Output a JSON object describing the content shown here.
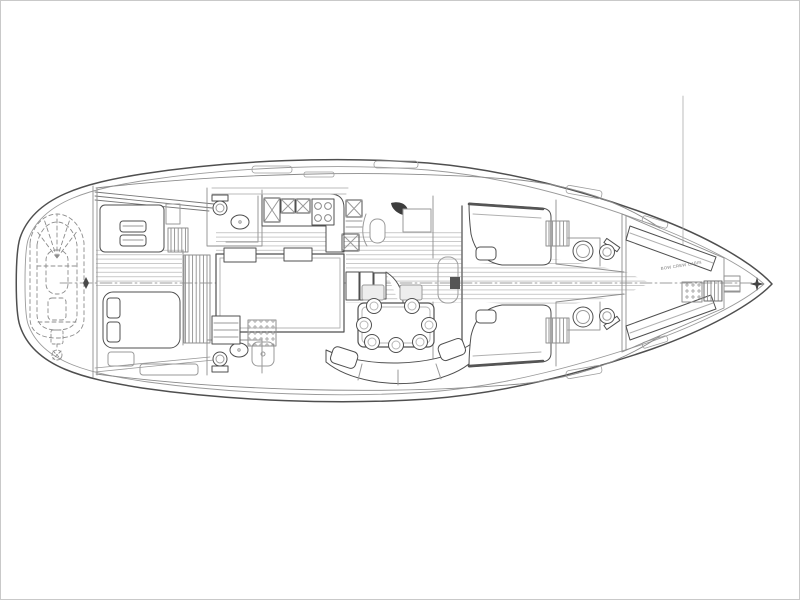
{
  "canvas": {
    "width": 800,
    "height": 600,
    "background": "#ffffff",
    "border_color": "#c9c9c9"
  },
  "drawing": {
    "ink": "#4f4f4f",
    "ink_light": "#9a9a9a",
    "plank_line": "#bcbcbc",
    "dark_accent": "#3d3d3d",
    "bow_cabin_label": "BOW CREW CABIN"
  }
}
